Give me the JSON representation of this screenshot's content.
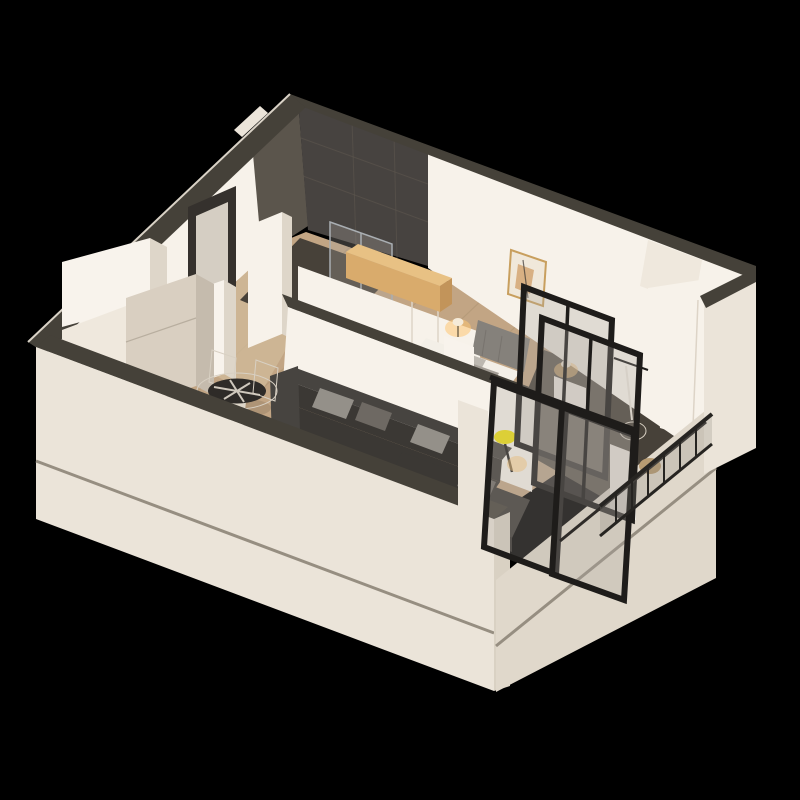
{
  "render": {
    "kind": "isometric-apartment-3d-render",
    "background": "#000000"
  },
  "colors": {
    "background": "#000000",
    "wall_exterior": "#ebe4d9",
    "wall_exterior_shade": "#e0d8cb",
    "wall_end": "#d9d1c3",
    "wall_top": "#454139",
    "wall_interior": "#f7f2ea",
    "wall_interior_dim": "#efe8dd",
    "tile_dark": "#5b554c",
    "tile_darker": "#474340",
    "floor_wood": "#c2a584",
    "floor_corridor": "#cfb998",
    "floor_dark": "#474139",
    "groove": "#968e81",
    "door_dark": "#35312d",
    "door_light": "#d5cec3",
    "white_furniture": "#f8f3ec",
    "furniture_shade": "#ded6c9",
    "appliance": "#d9cfc1",
    "appliance_side": "#c5bbad",
    "glass": "rgba(173,167,158,0.30)",
    "chrome": "#a9aeb2",
    "wood_cabinet": "#d9ab6c",
    "wood_cabinet_top": "#e8c184",
    "wood_cabinet_side": "#c2945a",
    "headboard": "#85817b",
    "bed_linen": "#f3efe7",
    "pillow_light": "#bdb8b0",
    "pillow_dark": "#a49e96",
    "bed_blanket": "#2b3140",
    "rug": "#d5bf9d",
    "sofa": "#3b3834",
    "sofa_top": "#474440",
    "sofa_dark": "#2f2c29",
    "sofa_pillow_light": "#949089",
    "sofa_pillow_dark": "#6e6963",
    "table_glass": "#2e2b28",
    "art_frame": "#c89f5e",
    "art_paper": "#f0e8da",
    "art_accent": "#d8b083",
    "metal": "#1e1c1a",
    "railing": "#262421",
    "railing_glass": "rgba(140,135,128,0.25)",
    "lamp_yellow": "#f1e10b",
    "lamp_glow": "#ffc772",
    "lamp_shade": "#f5ebd9",
    "basket": "#b79b72",
    "balcony_edge": "#2e2b28",
    "shadow": "rgba(0,0,0,0.10)"
  },
  "scene": {
    "rooms": [
      "entry",
      "kitchen",
      "bathroom",
      "living-room",
      "dining-area",
      "bedroom",
      "balcony"
    ],
    "furniture": [
      "kitchen-cabinets",
      "refrigerator",
      "entry-door",
      "shoe-cabinet",
      "shower",
      "wood-counter-cabinet",
      "wardrobe",
      "double-bed",
      "nightstands",
      "table-lamps",
      "wall-artwork",
      "area-rug",
      "corner-sofa",
      "sofa-cushions",
      "round-dining-table",
      "dining-chairs",
      "yellow-floor-lamp",
      "glass-partition",
      "sliding-glass-doors",
      "balcony-railing",
      "hanging-chair",
      "balcony-cabinet"
    ]
  }
}
